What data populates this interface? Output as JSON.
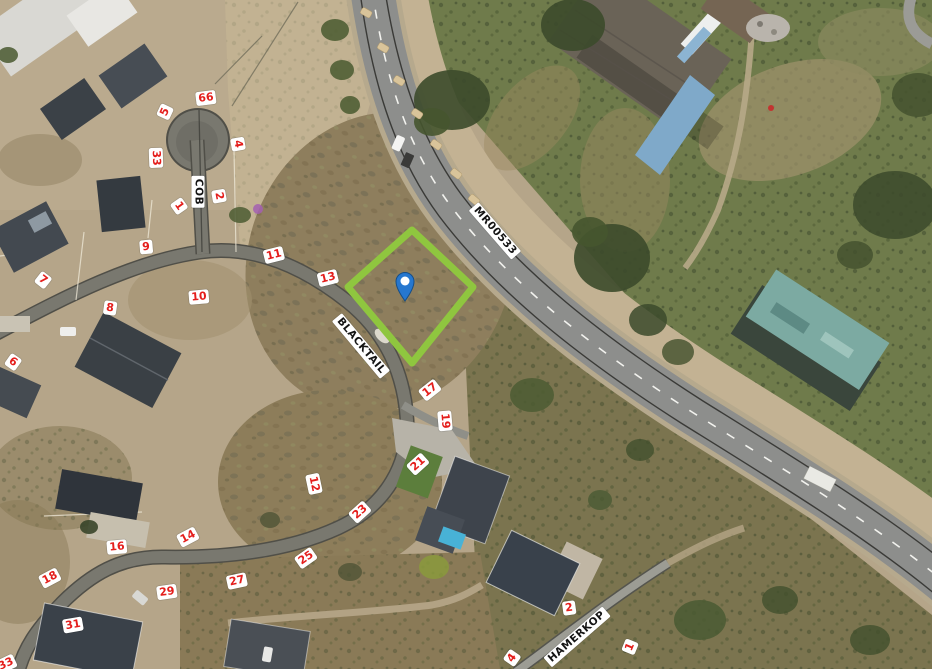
{
  "app": {
    "type": "aerial-map-view"
  },
  "colors": {
    "plot_highlight": "#8fc63f",
    "marker_blue": "#2677cf",
    "marker_dot": "#ffffff",
    "lot_label_red": "#e41e1c",
    "label_bg": "#ffffff",
    "street_label_text": "#141414"
  },
  "map": {
    "marker": {
      "name": "selected-location-pin",
      "x": 405,
      "y": 301
    },
    "highlighted_plot": {
      "shape": "diamond",
      "corners": [
        [
          412,
          230
        ],
        [
          473,
          287
        ],
        [
          412,
          363
        ],
        [
          348,
          287
        ]
      ]
    },
    "street_labels": [
      {
        "text": "COB",
        "x": 198,
        "y": 192,
        "rot": 90
      },
      {
        "text": "BLACKTAIL",
        "x": 361,
        "y": 346,
        "rot": 50
      },
      {
        "text": "MR00533",
        "x": 495,
        "y": 231,
        "rot": 49
      },
      {
        "text": "HAMERKOP",
        "x": 577,
        "y": 637,
        "rot": -41
      }
    ],
    "lot_labels": [
      {
        "text": "66",
        "x": 206,
        "y": 98,
        "rot": -7
      },
      {
        "text": "5",
        "x": 165,
        "y": 112,
        "rot": -65
      },
      {
        "text": "4",
        "x": 238,
        "y": 144,
        "rot": 80
      },
      {
        "text": "33",
        "x": 156,
        "y": 158,
        "rot": 88
      },
      {
        "text": "2",
        "x": 219,
        "y": 196,
        "rot": 80
      },
      {
        "text": "1",
        "x": 179,
        "y": 206,
        "rot": 55
      },
      {
        "text": "9",
        "x": 146,
        "y": 247,
        "rot": -5
      },
      {
        "text": "7",
        "x": 43,
        "y": 280,
        "rot": 38
      },
      {
        "text": "8",
        "x": 110,
        "y": 308,
        "rot": 8
      },
      {
        "text": "10",
        "x": 199,
        "y": 297,
        "rot": -5
      },
      {
        "text": "6",
        "x": 13,
        "y": 362,
        "rot": 35
      },
      {
        "text": "11",
        "x": 274,
        "y": 255,
        "rot": -14
      },
      {
        "text": "13",
        "x": 328,
        "y": 278,
        "rot": -14
      },
      {
        "text": "17",
        "x": 430,
        "y": 390,
        "rot": -38
      },
      {
        "text": "19",
        "x": 445,
        "y": 421,
        "rot": 85
      },
      {
        "text": "21",
        "x": 418,
        "y": 464,
        "rot": -42
      },
      {
        "text": "12",
        "x": 314,
        "y": 484,
        "rot": 78
      },
      {
        "text": "23",
        "x": 360,
        "y": 512,
        "rot": -42
      },
      {
        "text": "25",
        "x": 306,
        "y": 558,
        "rot": -35
      },
      {
        "text": "27",
        "x": 237,
        "y": 581,
        "rot": -12
      },
      {
        "text": "29",
        "x": 167,
        "y": 592,
        "rot": -8
      },
      {
        "text": "14",
        "x": 188,
        "y": 537,
        "rot": -28
      },
      {
        "text": "16",
        "x": 117,
        "y": 547,
        "rot": -5
      },
      {
        "text": "18",
        "x": 50,
        "y": 578,
        "rot": -28
      },
      {
        "text": "31",
        "x": 73,
        "y": 625,
        "rot": -10
      },
      {
        "text": "33",
        "x": 6,
        "y": 664,
        "rot": -25
      },
      {
        "text": "2",
        "x": 569,
        "y": 608,
        "rot": -8
      },
      {
        "text": "1",
        "x": 630,
        "y": 647,
        "rot": -68
      },
      {
        "text": "4",
        "x": 512,
        "y": 658,
        "rot": -55
      }
    ]
  }
}
